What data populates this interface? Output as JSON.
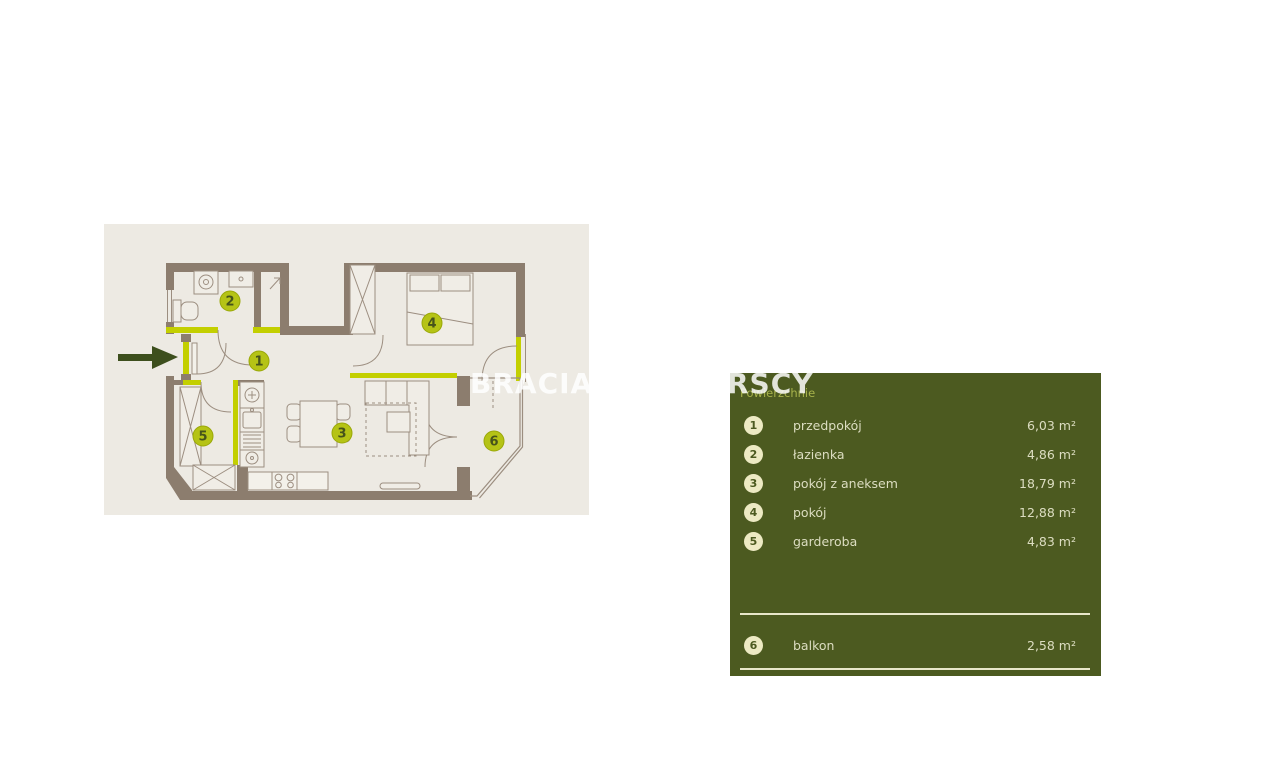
{
  "page": {
    "background": "#ffffff"
  },
  "watermark": {
    "fragment_left": "BRACIA/",
    "fragment_right": "RSCY",
    "color": "#ffffff"
  },
  "floor_plan": {
    "background_color": "#edeae3",
    "wall_color": "#8c7d6e",
    "accent_color": "#c3cf00",
    "marker_fill": "#b5c316",
    "marker_text_color": "#46531b",
    "entrance_arrow_color": "#3d4f1d",
    "markers": [
      "1",
      "2",
      "3",
      "4",
      "5",
      "6"
    ]
  },
  "legend": {
    "background": "#4c5a20",
    "title": "Powierzchnie",
    "title_color": "#a7b24b",
    "circle_fill": "#edeac3",
    "text_color": "#dcddc1",
    "divider_color": "#e8e7ca",
    "rows": [
      {
        "num": "1",
        "label": "przedpokój",
        "area": "6,03 m²"
      },
      {
        "num": "2",
        "label": "łazienka",
        "area": "4,86 m²"
      },
      {
        "num": "3",
        "label": "pokój z aneksem",
        "area": "18,79 m²"
      },
      {
        "num": "4",
        "label": "pokój",
        "area": "12,88 m²"
      },
      {
        "num": "5",
        "label": "garderoba",
        "area": "4,83 m²"
      },
      {
        "num": "6",
        "label": "balkon",
        "area": "2,58 m²"
      }
    ]
  }
}
